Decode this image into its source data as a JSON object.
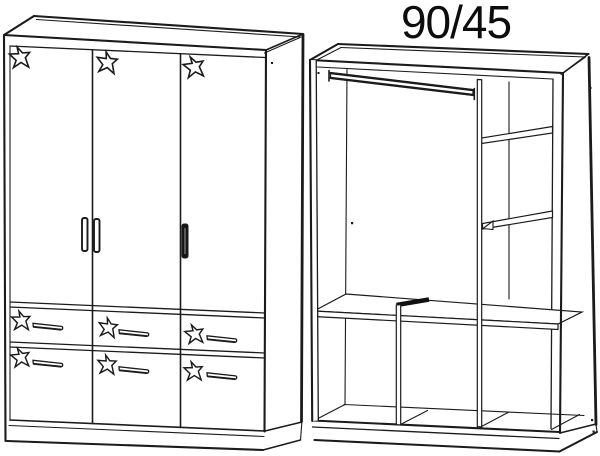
{
  "title": "90/45",
  "colors": {
    "background": "#ffffff",
    "line": "#1b1b1b",
    "handle_filled": "#161616"
  },
  "diagram": {
    "kind": "wardrobe line drawing, two views",
    "left_view": {
      "name": "wardrobe exterior front view",
      "doors": 3,
      "door_star_decorations": 3,
      "drawers": 6,
      "drawer_star_decorations": 6,
      "door_handles": 3,
      "drawer_handles": 6
    },
    "right_view": {
      "name": "wardrobe interior view",
      "dimension_label": "90/45",
      "hanging_rails": 1,
      "side_shelves": 2,
      "full_width_shelves": 1,
      "vertical_dividers": 2,
      "lower_compartments": 3
    }
  }
}
